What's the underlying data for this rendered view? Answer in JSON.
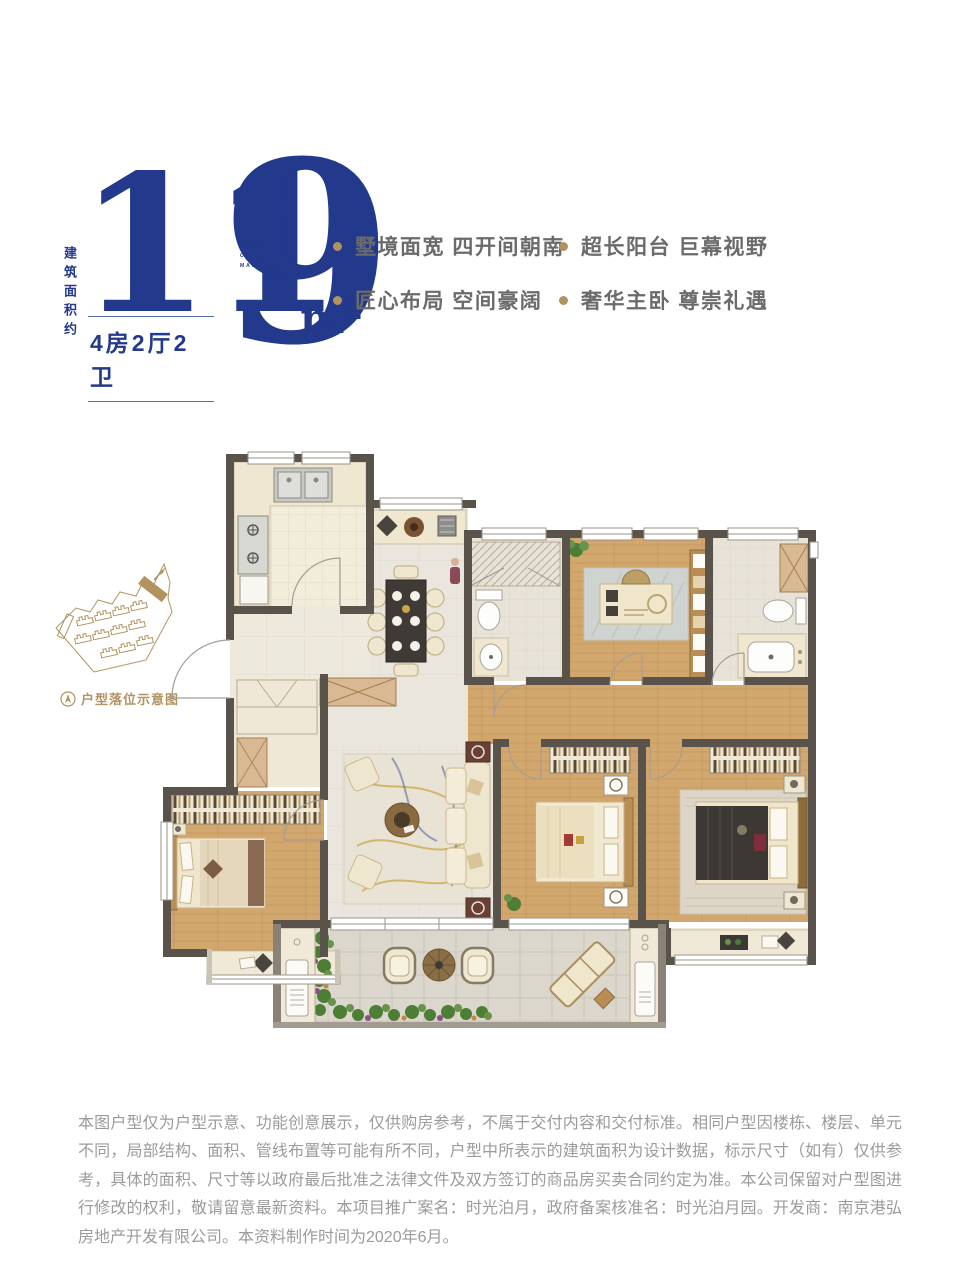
{
  "hero": {
    "area_label_vertical": "建筑面积约",
    "area_value_first": "11",
    "area_value_last": "9",
    "area_unit": "m²",
    "watermark": {
      "line1": "RIVER",
      "line2": "OF",
      "line3": "MANSION"
    },
    "unit_badge": "4房2厅2卫",
    "features": [
      {
        "label": "墅境面宽  四开间朝南"
      },
      {
        "label": "超长阳台  巨幕视野"
      },
      {
        "label": "匠心布局  空间豪阔"
      },
      {
        "label": "奢华主卧  尊崇礼遇"
      }
    ]
  },
  "site_plan": {
    "caption": "户型落位示意图"
  },
  "colors": {
    "accent_blue": "#22398c",
    "accent_gold": "#b2935f",
    "feature_text": "#6b6b6b",
    "disclaimer_text": "#9b9b9b",
    "wall": "#5a534c",
    "wood_floor": "#d2a76d"
  },
  "disclaimer": {
    "text": "本图户型仅为户型示意、功能创意展示，仅供购房参考，不属于交付内容和交付标准。相同户型因楼栋、楼层、单元不同，局部结构、面积、管线布置等可能有所不同，户型中所表示的建筑面积为设计数据，标示尺寸（如有）仅供参考，具体的面积、尺寸等以政府最后批准之法律文件及双方签订的商品房买卖合同约定为准。本公司保留对户型图进行修改的权利，敬请留意最新资料。本项目推广案名：时光泊月，政府备案核准名：时光泊月园。开发商：南京港弘房地产开发有限公司。本资料制作时间为2020年6月。"
  }
}
